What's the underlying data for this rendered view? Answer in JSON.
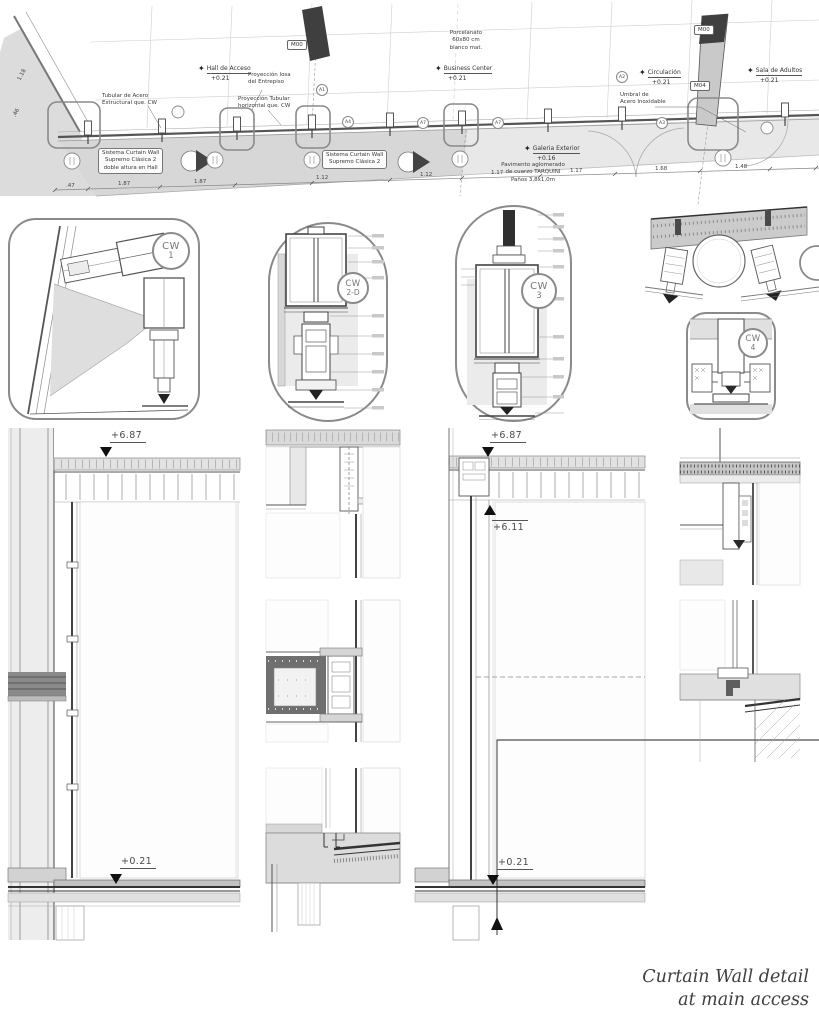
{
  "sheet": {
    "title_line1": "Curtain Wall detail",
    "title_line2": "at main access"
  },
  "plan": {
    "tags": {
      "m00_a": "M00",
      "m00_b": "M00",
      "m04": "M04"
    },
    "rooms": [
      {
        "name": "Hall de Acceso",
        "level": "+0.21"
      },
      {
        "name": "Business Center",
        "level": "+0.21"
      },
      {
        "name": "Circulación",
        "level": "+0.21"
      },
      {
        "name": "Sala de Adultos",
        "level": "+0.21"
      },
      {
        "name": "Galeria Exterior",
        "level": "+0.16"
      }
    ],
    "notes": {
      "porcelanato": "Porcelanato\n60x80 cm\nblanco mat.",
      "tubular_acero": "Tubular de Acero\nEstructural que. CW",
      "proy_losa": "Proyección losa\ndel Entrepiso",
      "proy_tubular": "Proyección Tubular\nhorizontal que. CW",
      "umbral": "Umbral de\nAcero Inoxidable",
      "sistema_hall": "Sistema Curtain Wall\nSupremo Clásica 2\ndoble altura en Hall",
      "sistema_2": "Sistema Curtain Wall\nSupremo Clásica 2",
      "pavimento": "Pavimento aglomerado\nde cuarzo TARQUINI\nPaños 3,8x1,0m"
    },
    "grid_bubbles": [
      "A1",
      "A4",
      "A7",
      "A7",
      "A2",
      "A3"
    ],
    "dimensions": [
      ".47",
      "1.87",
      "1.87",
      "1.12",
      "1.12",
      "1.17",
      "1.17",
      "1.68",
      "1.48"
    ],
    "left_dimensions": [
      "1.18",
      ".46"
    ]
  },
  "callouts": [
    {
      "code": "CW",
      "num": "1"
    },
    {
      "code": "CW",
      "num": "2-D"
    },
    {
      "code": "CW",
      "num": "3"
    },
    {
      "code": "CW",
      "num": "4"
    }
  ],
  "levels": {
    "left_top": "+6.87",
    "left_bottom": "+0.21",
    "right_top": "+6.87",
    "right_mid": "+6.11",
    "right_bottom": "+0.21"
  },
  "colors": {
    "line": "#4a4a4a",
    "poche_light": "#dcdcdc",
    "poche_dark": "#6f6f6f",
    "accent_dark": "#2e2e2e",
    "title_text": "#3f3f3f"
  }
}
